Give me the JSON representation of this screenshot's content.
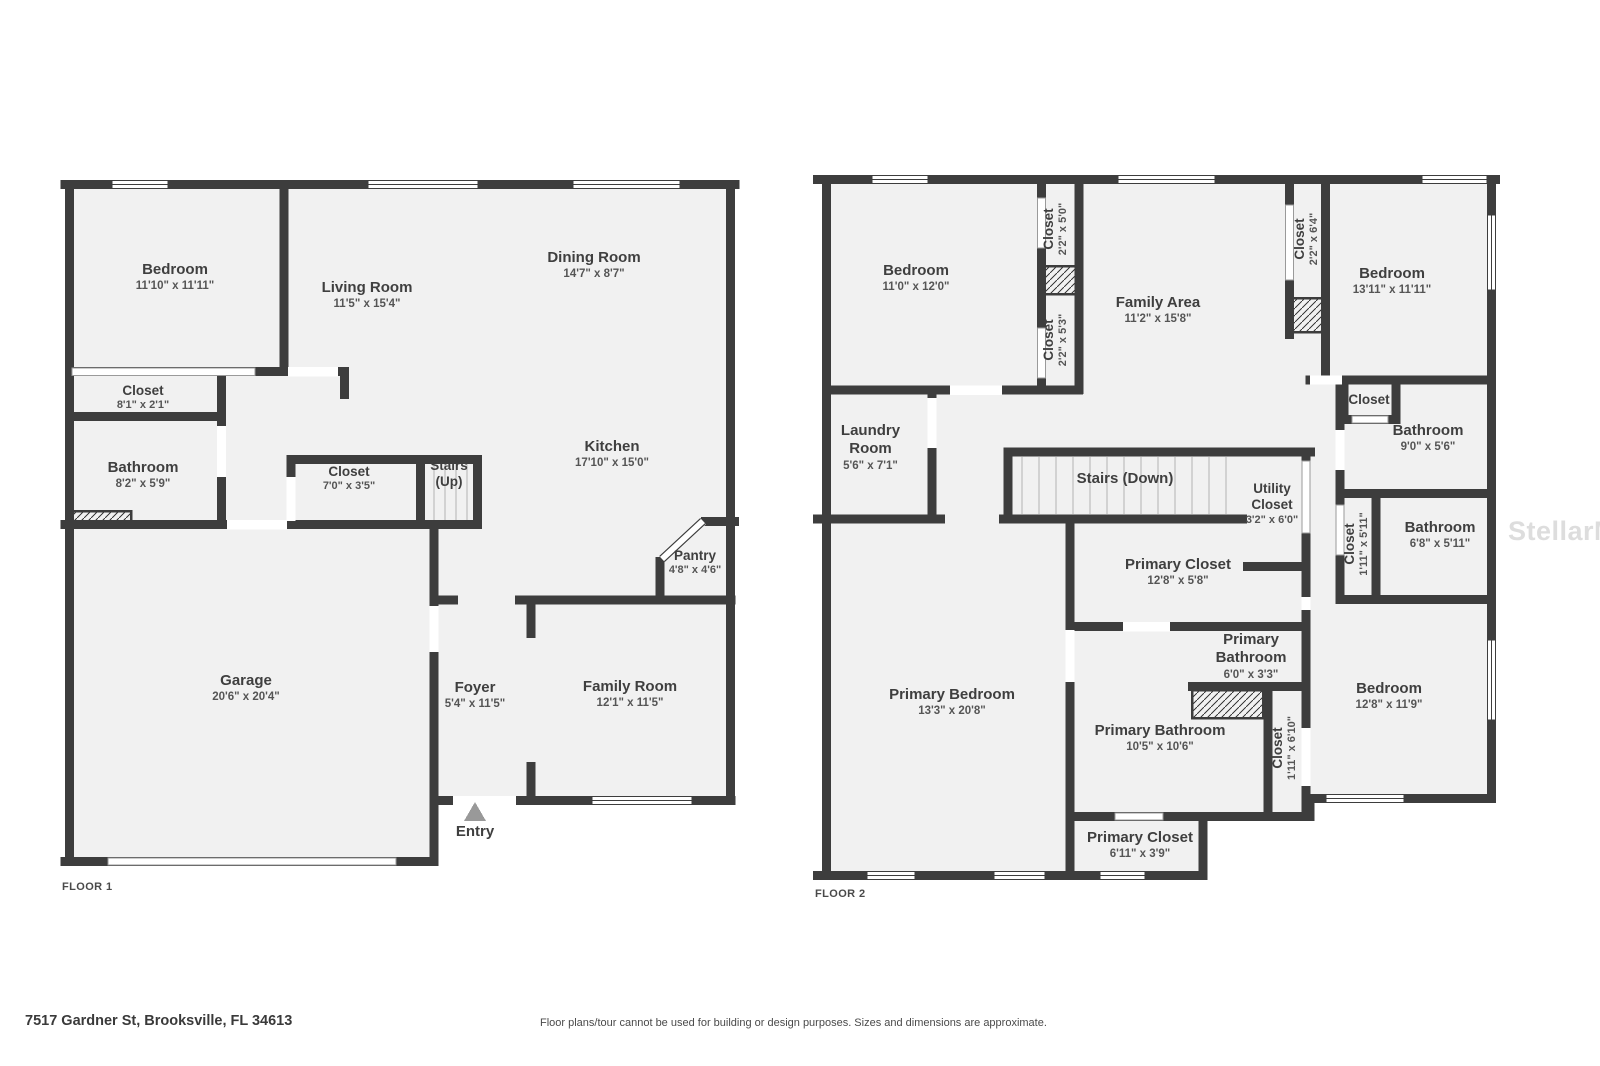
{
  "page": {
    "address": "7517 Gardner St, Brooksville, FL 34613",
    "disclaimer": "Floor plans/tour cannot be used for building or design purposes. Sizes and dimensions are approximate.",
    "watermark": "StellarMLS"
  },
  "colors": {
    "wall": "#3d3d3d",
    "floor_fill": "#f1f1f1",
    "label_text": "#3f3f3f",
    "dims_text": "#555555",
    "watermark_text": "#d2d2d2",
    "entry_marker": "#999999"
  },
  "floor1": {
    "label": "FLOOR 1",
    "rooms": {
      "bedroom": {
        "name": "Bedroom",
        "dims": "11'10\" x 11'11\""
      },
      "living": {
        "name": "Living Room",
        "dims": "11'5\" x 15'4\""
      },
      "dining": {
        "name": "Dining Room",
        "dims": "14'7\" x 8'7\""
      },
      "closet_a": {
        "name": "Closet",
        "dims": "8'1\" x 2'1\""
      },
      "bathroom": {
        "name": "Bathroom",
        "dims": "8'2\" x 5'9\""
      },
      "closet_b": {
        "name": "Closet",
        "dims": "7'0\" x 3'5\""
      },
      "stairs_up": {
        "name": "Stairs",
        "dims": "(Up)"
      },
      "kitchen": {
        "name": "Kitchen",
        "dims": "17'10\" x 15'0\""
      },
      "pantry": {
        "name": "Pantry",
        "dims": "4'8\" x 4'6\""
      },
      "garage": {
        "name": "Garage",
        "dims": "20'6\" x 20'4\""
      },
      "foyer": {
        "name": "Foyer",
        "dims": "5'4\" x 11'5\""
      },
      "family": {
        "name": "Family Room",
        "dims": "12'1\" x 11'5\""
      },
      "entry": {
        "name": "Entry"
      }
    }
  },
  "floor2": {
    "label": "FLOOR 2",
    "rooms": {
      "bedroom_left": {
        "name": "Bedroom",
        "dims": "11'0\" x 12'0\""
      },
      "closet_top_1": {
        "name": "Closet",
        "dims": "2'2\" x 5'0\""
      },
      "closet_top_2": {
        "name": "Closet",
        "dims": "2'2\" x 5'3\""
      },
      "family_area": {
        "name": "Family Area",
        "dims": "11'2\" x 15'8\""
      },
      "closet_top_3": {
        "name": "Closet",
        "dims": "2'2\" x 6'4\""
      },
      "bedroom_right": {
        "name": "Bedroom",
        "dims": "13'11\" x 11'11\""
      },
      "laundry": {
        "name": "Laundry Room",
        "dims": "5'6\" x 7'1\""
      },
      "stairs_down": {
        "name": "Stairs (Down)"
      },
      "utility_closet": {
        "name": "Utility Closet",
        "dims": "3'2\" x 6'0\""
      },
      "closet_mid": {
        "name": "Closet"
      },
      "bathroom_1": {
        "name": "Bathroom",
        "dims": "9'0\" x 5'6\""
      },
      "closet_v1": {
        "name": "Closet",
        "dims": "1'11\" x 5'11\""
      },
      "bathroom_2": {
        "name": "Bathroom",
        "dims": "6'8\" x 5'11\""
      },
      "primary_closet_1": {
        "name": "Primary Closet",
        "dims": "12'8\" x 5'8\""
      },
      "primary_bathroom_1": {
        "name": "Primary Bathroom",
        "dims": "6'0\" x 3'3\""
      },
      "primary_bathroom_2": {
        "name": "Primary Bathroom",
        "dims": "10'5\" x 10'6\""
      },
      "closet_v2": {
        "name": "Closet",
        "dims": "1'11\" x 6'10\""
      },
      "bedroom_3": {
        "name": "Bedroom",
        "dims": "12'8\" x 11'9\""
      },
      "primary_bedroom": {
        "name": "Primary Bedroom",
        "dims": "13'3\" x 20'8\""
      },
      "primary_closet_2": {
        "name": "Primary Closet",
        "dims": "6'11\" x 3'9\""
      }
    }
  }
}
